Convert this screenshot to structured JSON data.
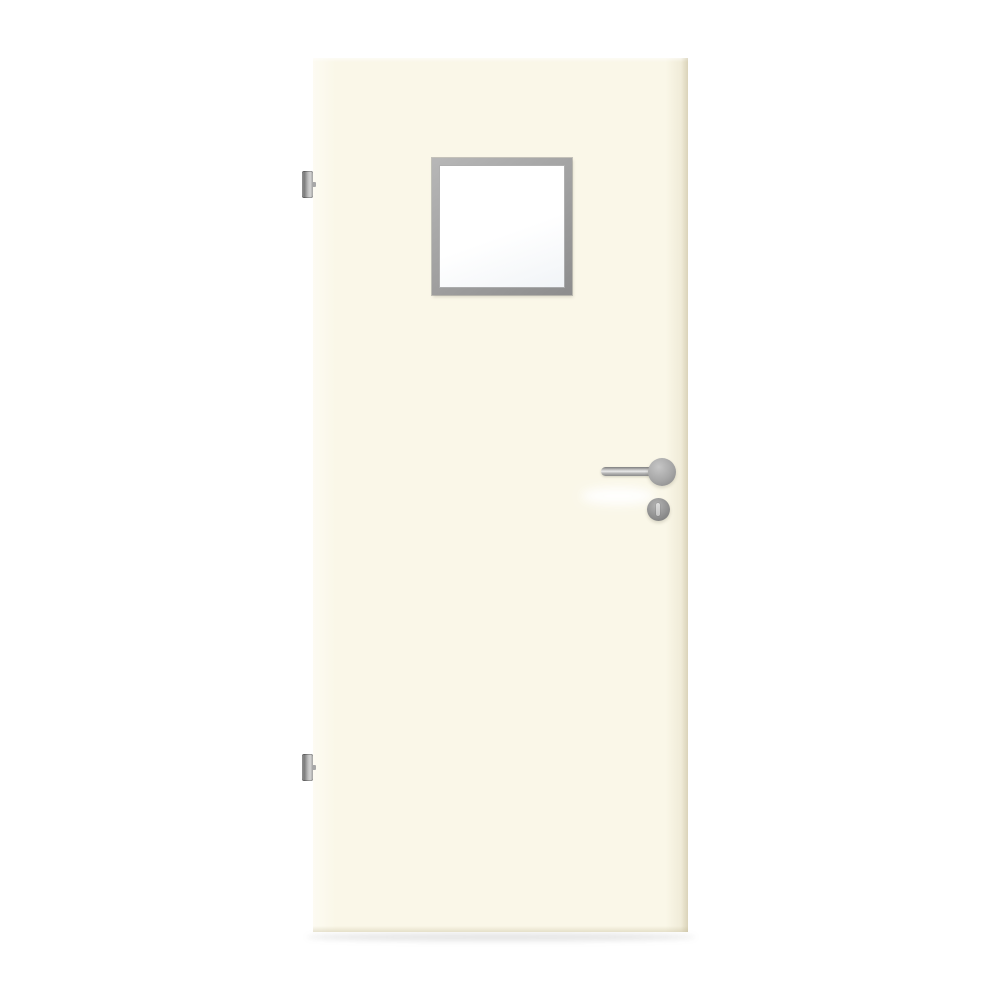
{
  "scene": {
    "kind": "product-image",
    "subject": "interior door leaf, cream finish, square vision panel, stainless lever handle, two hinges",
    "background": "plain white",
    "text_content": "none"
  },
  "door": {
    "finish_name": "cream",
    "components": [
      "door-leaf",
      "vision-panel-frame",
      "vision-panel-glass",
      "hinge-top",
      "hinge-bottom",
      "lever-handle",
      "handle-rose",
      "key-escutcheon",
      "keyhole-slot",
      "floor-shadow"
    ],
    "hinge_count": 2,
    "handle_side": "right",
    "handle_style": "straight stainless lever on round rose with separate round key escutcheon below",
    "vision_panel_shape": "square, upper center of leaf"
  },
  "colors": {
    "background": "#ffffff",
    "door_face": "#faf7e8",
    "door_face_light": "#fdfbf2",
    "door_edge_shade": "#ece7d2",
    "frame_light": "#b7b7b7",
    "frame_dark": "#8d8d8d",
    "glass_white": "#ffffff",
    "glass_tint": "#f1f4f7",
    "steel_light": "#e9e9e9",
    "steel_mid": "#a6a6a6",
    "steel_dark": "#7d7d7d",
    "keyhole_slot": "#dedede"
  }
}
